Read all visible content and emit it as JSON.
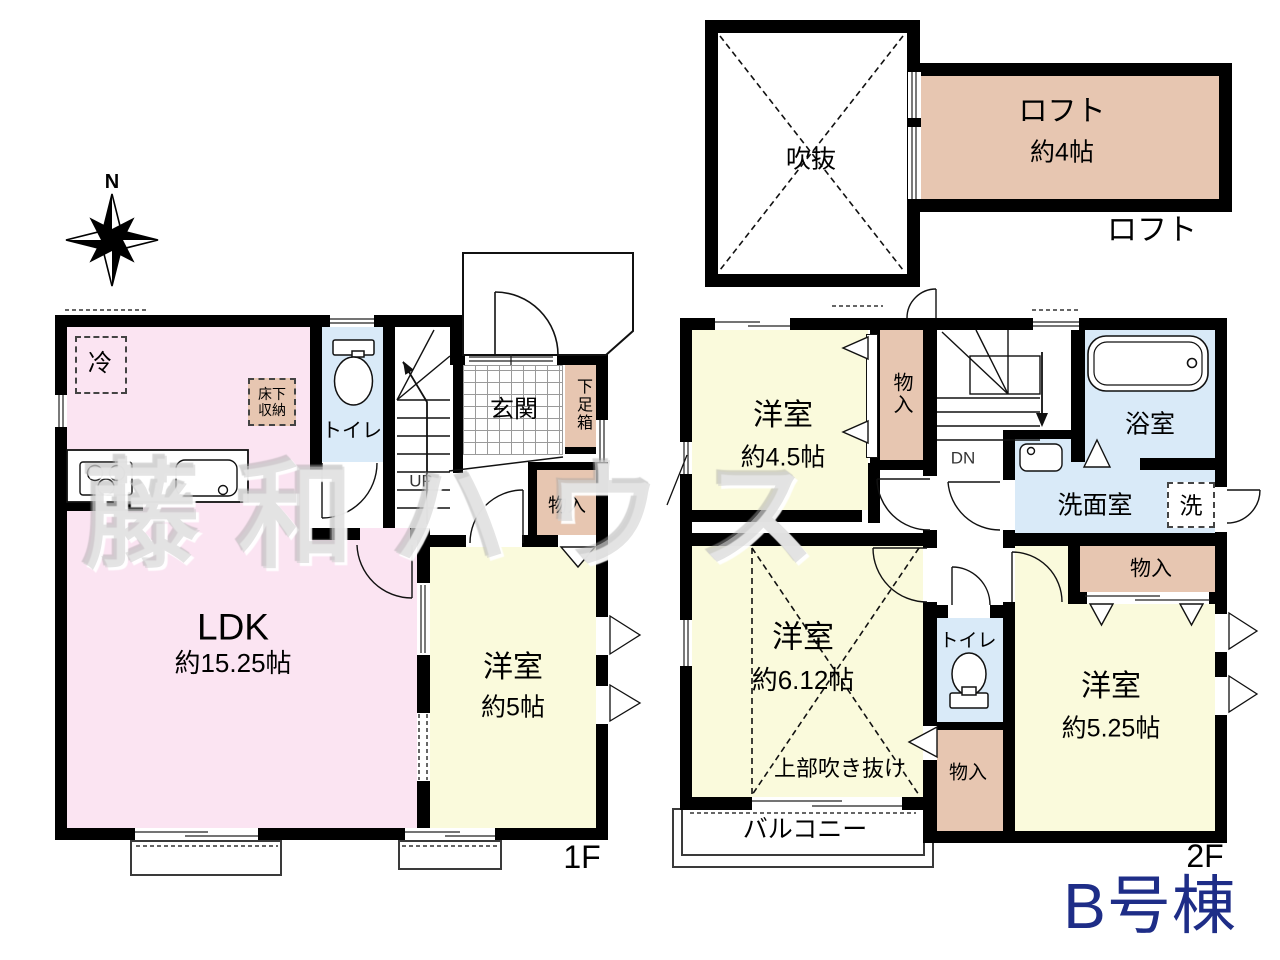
{
  "building_label": "B号棟",
  "watermark": "藤和ハウス",
  "compass": {
    "north": "N"
  },
  "colors": {
    "ldk_pink": "#fbe4f2",
    "room_yellow": "#fafadc",
    "wet_blue": "#d9eaf8",
    "closet_tan": "#e7c6b1",
    "wall_black": "#000000",
    "building_navy": "#1e2d87"
  },
  "loft_section": {
    "void_room": "吹抜",
    "loft_room": "ロフト",
    "loft_size": "約4帖",
    "caption": "ロフト"
  },
  "floor1": {
    "caption": "1F",
    "ldk": "LDK",
    "ldk_size": "約15.25帖",
    "bedroom": "洋室",
    "bedroom_size": "約5帖",
    "toilet": "トイレ",
    "entrance": "玄関",
    "shoe_box": "下足箱",
    "closet": "物入",
    "fridge": "冷",
    "underfloor_1": "床下",
    "underfloor_2": "収納",
    "up": "UP"
  },
  "floor2": {
    "caption": "2F",
    "bedroom_a": "洋室",
    "bedroom_a_size": "約4.5帖",
    "closet_top": "物入",
    "down": "DN",
    "bath": "浴室",
    "washroom": "洗面室",
    "washer": "洗",
    "toilet": "トイレ",
    "closet_mid": "物入",
    "bedroom_b": "洋室",
    "bedroom_b_size": "約6.12帖",
    "void_note": "上部吹き抜け",
    "balcony": "バルコニー",
    "closet_right": "物入",
    "bedroom_c": "洋室",
    "bedroom_c_size": "約5.25帖"
  }
}
